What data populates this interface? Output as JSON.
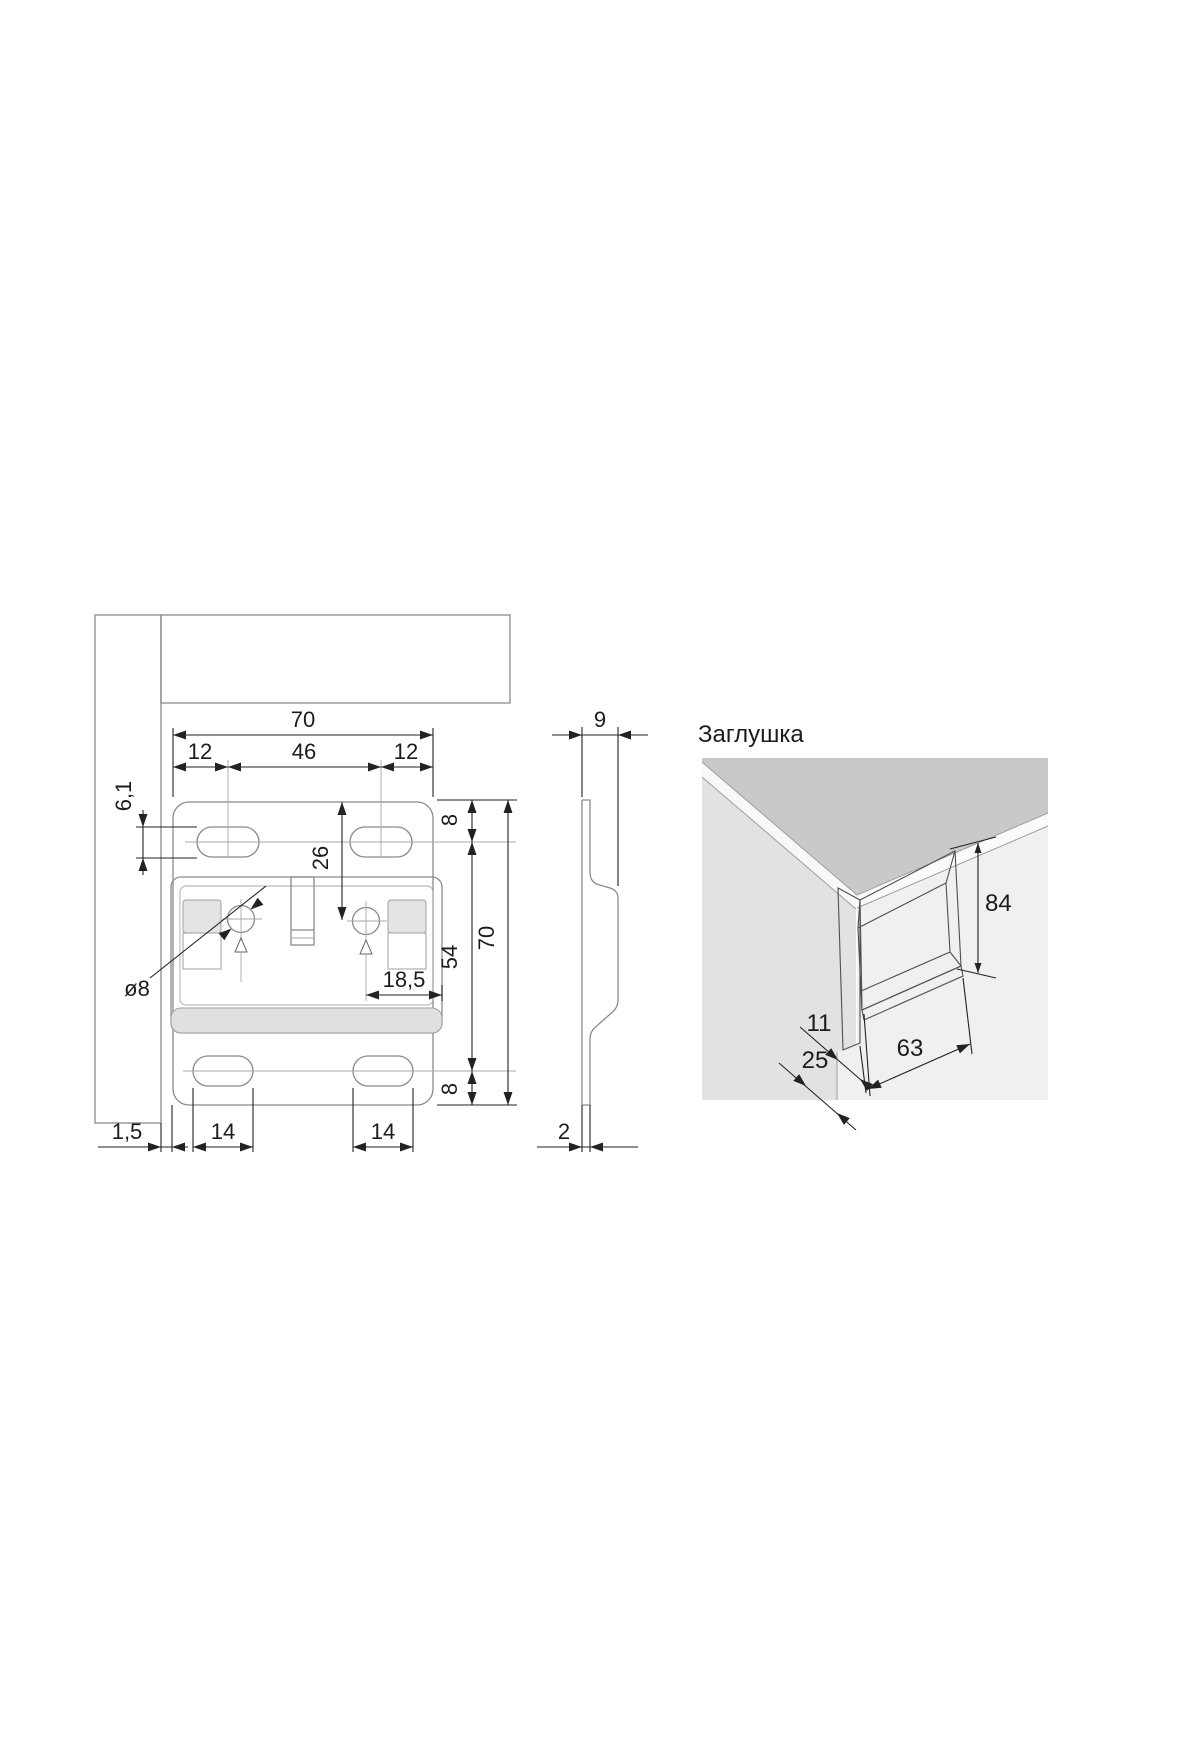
{
  "front": {
    "width_total": "70",
    "offset_left": "12",
    "span_center": "46",
    "offset_right": "12",
    "slot_height": "6,1",
    "top_to_hole": "26",
    "edge_to_slot_top": "8",
    "slot_span": "54",
    "height_total": "70",
    "edge_to_slot_bottom": "8",
    "hole_to_edge": "18,5",
    "hole_dia": "ø8",
    "wall_gap": "1,5",
    "slot_len_left": "14",
    "slot_len_right": "14"
  },
  "side": {
    "depth": "9",
    "thickness": "2"
  },
  "cap": {
    "title": "Заглушка",
    "height": "84",
    "edge_width": "11",
    "side_depth": "25",
    "width": "63"
  },
  "colors": {
    "plate_fill": "#ececec",
    "body_fill": "#e8e8e8",
    "top_face": "#c9c9c9",
    "left_face": "#e2e2e2",
    "right_face": "#f0f0f0",
    "dim_color": "#222222"
  }
}
